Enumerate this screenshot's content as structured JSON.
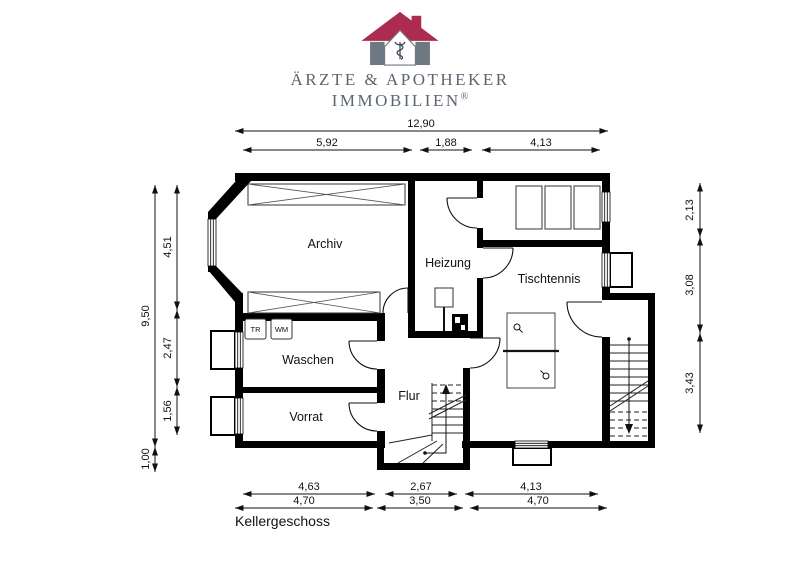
{
  "brand": {
    "name_line1": "ÄRZTE & APOTHEKER",
    "name_line2": "IMMOBILIEN",
    "registered_mark": "®",
    "colors": {
      "roof": "#ac2b4e",
      "house_walls": "#6e7882"
    }
  },
  "plan": {
    "floor_label": "Kellergeschoss",
    "rooms": {
      "archiv": "Archiv",
      "heizung": "Heizung",
      "tischtennis": "Tischtennis",
      "waschen": "Waschen",
      "vorrat": "Vorrat",
      "flur": "Flur"
    },
    "appliances": {
      "dryer": "TR",
      "washer": "WM"
    },
    "dimensions": {
      "top": {
        "overall": "12,90",
        "segments": [
          "5,92",
          "1,88",
          "4,13"
        ]
      },
      "left": {
        "overall": "9,50",
        "extension": "1,00",
        "segments": [
          "4,51",
          "2,47",
          "1,56"
        ]
      },
      "right": {
        "segments": [
          "2,13",
          "3,08",
          "3,43"
        ]
      },
      "bottom": {
        "row1": [
          "4,63",
          "2,67",
          "4,13"
        ],
        "row2": [
          "4,70",
          "3,50",
          "4,70"
        ]
      }
    }
  }
}
